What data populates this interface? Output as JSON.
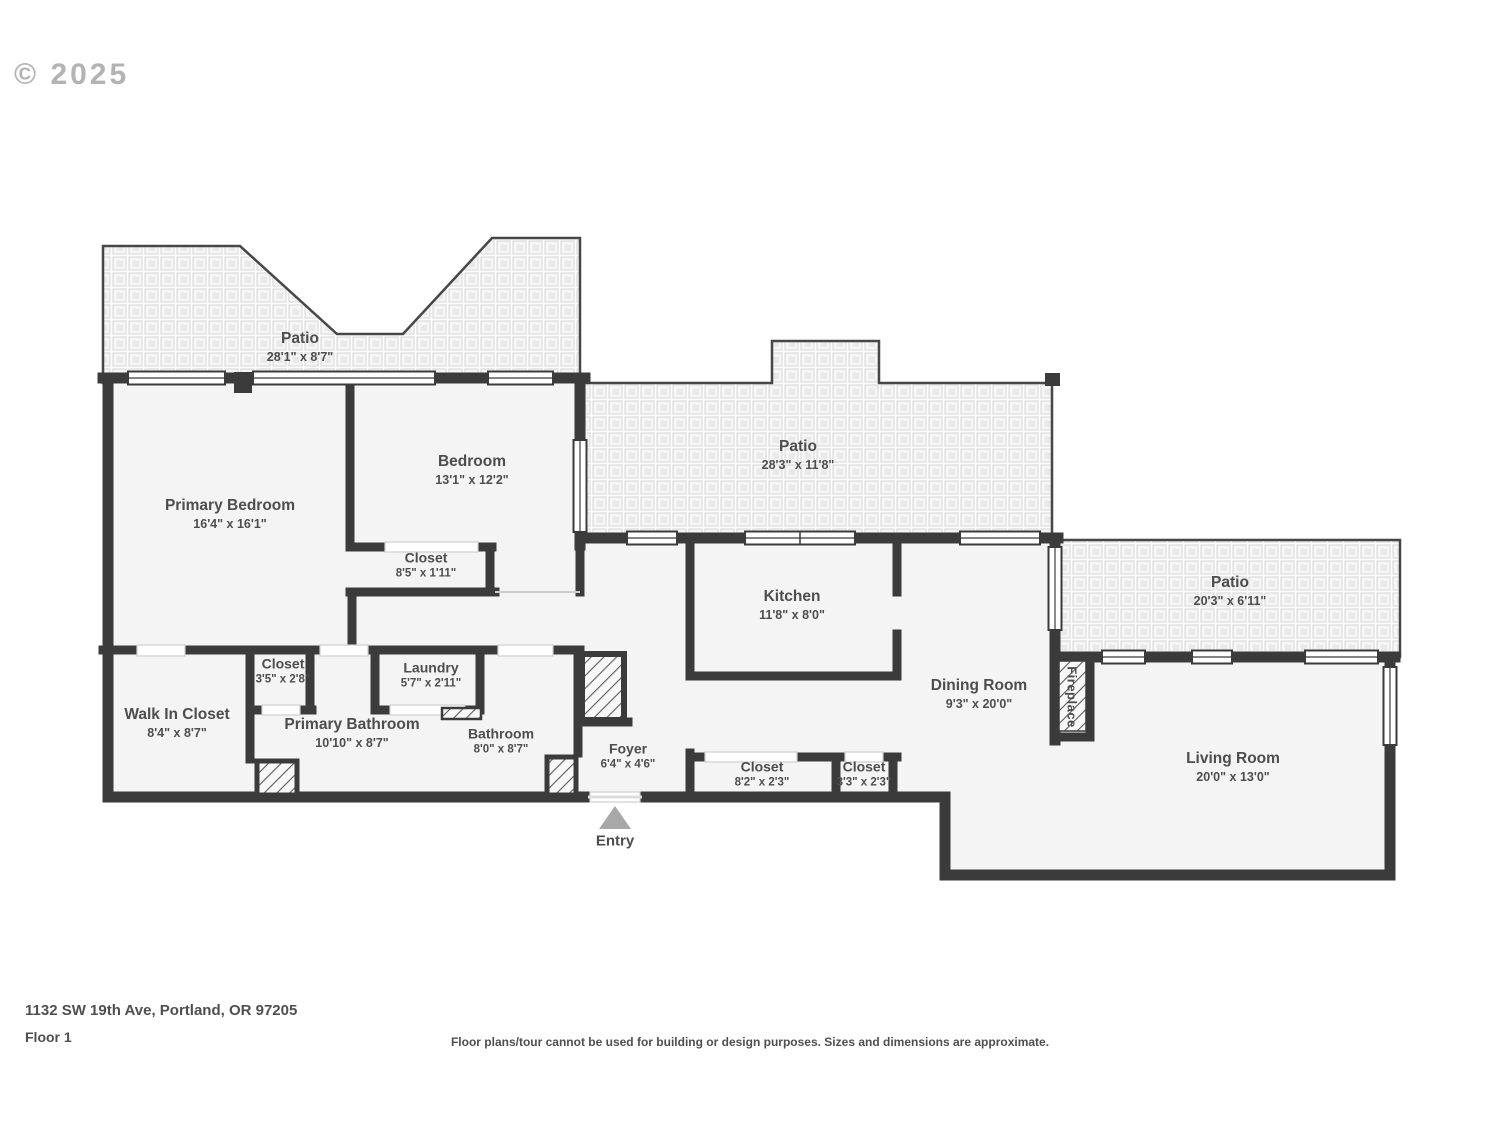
{
  "copyright": "© 2025",
  "rooms": [
    {
      "name": "Patio",
      "dims": "28'1\" x 8'7\""
    },
    {
      "name": "Primary Bedroom",
      "dims": "16'4\" x 16'1\""
    },
    {
      "name": "Bedroom",
      "dims": "13'1\" x 12'2\""
    },
    {
      "name": "Closet",
      "dims": "8'5\" x 1'11\""
    },
    {
      "name": "Patio",
      "dims": "28'3\" x 11'8\""
    },
    {
      "name": "Kitchen",
      "dims": "11'8\" x 8'0\""
    },
    {
      "name": "Patio",
      "dims": "20'3\" x 6'11\""
    },
    {
      "name": "Dining Room",
      "dims": "9'3\" x 20'0\""
    },
    {
      "name": "Living Room",
      "dims": "20'0\" x 13'0\""
    },
    {
      "name": "Walk In Closet",
      "dims": "8'4\" x 8'7\""
    },
    {
      "name": "Closet",
      "dims": "3'5\" x 2'8\""
    },
    {
      "name": "Laundry",
      "dims": "5'7\" x 2'11\""
    },
    {
      "name": "Primary Bathroom",
      "dims": "10'10\" x 8'7\""
    },
    {
      "name": "Bathroom",
      "dims": "8'0\" x 8'7\""
    },
    {
      "name": "Foyer",
      "dims": "6'4\" x 4'6\""
    },
    {
      "name": "Closet",
      "dims": "8'2\" x 2'3\""
    },
    {
      "name": "Closet",
      "dims": "3'3\" x 2'3\""
    }
  ],
  "labels": {
    "fireplace": "Fireplace",
    "entry": "Entry"
  },
  "footer": {
    "address": "1132 SW 19th Ave, Portland, OR 97205",
    "floor": "Floor 1",
    "disclaimer": "Floor plans/tour cannot be used for building or design purposes. Sizes and dimensions are approximate."
  },
  "colors": {
    "wall": "#3b3b3b",
    "room_fill": "#f4f4f4",
    "text": "#4d4d4d",
    "entry_arrow": "#a8a8a8"
  }
}
